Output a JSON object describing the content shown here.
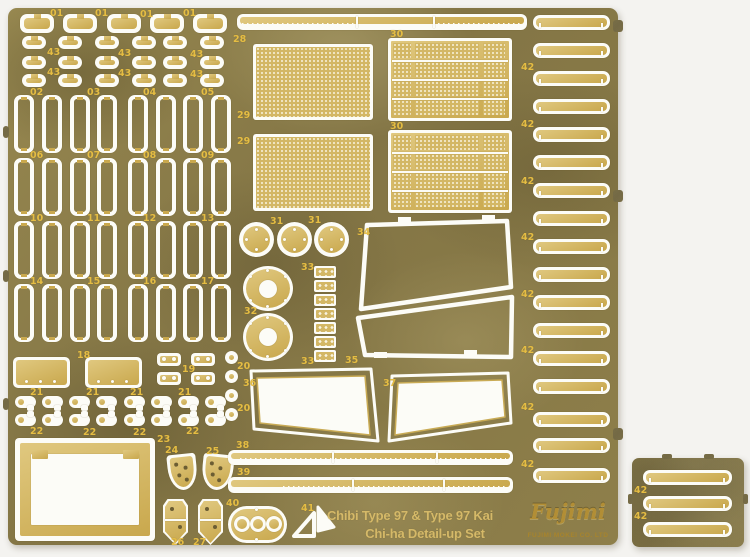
{
  "scene": {
    "title_line1": "Chibi Type 97 & Type 97 Kai",
    "title_line2": "Chi-ha Detail-up Set",
    "brand": {
      "script": "Fujimi",
      "caption": "FUJIMI MOKEI CO. LTD"
    }
  },
  "part_labels": {
    "p01": "01",
    "p02": "02",
    "p03": "03",
    "p04": "04",
    "p05": "05",
    "p06": "06",
    "p07": "07",
    "p08": "08",
    "p09": "09",
    "p10": "10",
    "p11": "11",
    "p12": "12",
    "p13": "13",
    "p14": "14",
    "p15": "15",
    "p16": "16",
    "p17": "17",
    "p18": "18",
    "p19": "19",
    "p20": "20",
    "p21": "21",
    "p22": "22",
    "p23": "23",
    "p24": "24",
    "p25": "25",
    "p26": "26",
    "p27": "27",
    "p28": "28",
    "p29": "29",
    "p30": "30",
    "p31": "31",
    "p32": "32",
    "p33": "33",
    "p34": "34",
    "p35": "35",
    "p36": "36",
    "p37": "37",
    "p38": "38",
    "p39": "39",
    "p40": "40",
    "p41": "41",
    "p42": "42",
    "p43": "43"
  },
  "colors": {
    "background": "#f4f3f0",
    "brass_base": "#8a7c48",
    "brass_dark": "#6e6238",
    "brass_light": "#a29256",
    "etch_gold": "#d3b765",
    "cut_white": "#fcfcf7",
    "label_gold": "#e5bd43",
    "title_gold": "#d5b968",
    "logo_gold": "#b28e35"
  }
}
